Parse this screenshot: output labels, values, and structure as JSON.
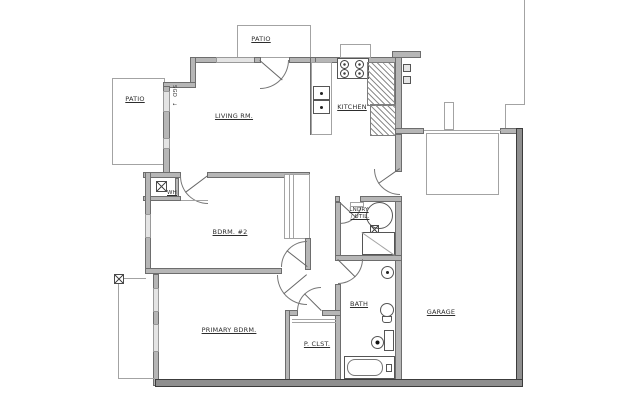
{
  "plan": {
    "labels": {
      "patio_top": "PATIO",
      "patio_left": "PATIO",
      "living_room": "LIVING RM.",
      "kitchen": "KITCHEN",
      "bedroom_2": "BDRM. #2",
      "primary_bedroom": "PRIMARY BDRM.",
      "primary_closet": "P. CLST.",
      "bath": "BATH",
      "garage": "GARAGE",
      "laundry_line1": "LNDRY",
      "laundry_line2": "/ UTIL.",
      "water_heater_closet": "WH",
      "patio_door": "SGD",
      "slide_arrow": "↓"
    },
    "colors": {
      "background": "#ffffff",
      "wall_fill": "#b6b6b6",
      "wall_edge": "#6d6d6d",
      "exterior_dark_fill": "#8f8f8f",
      "exterior_dark_edge": "#3c3c3c",
      "thin_line": "#a3a3a3",
      "label_text": "#2d2d2d"
    }
  }
}
